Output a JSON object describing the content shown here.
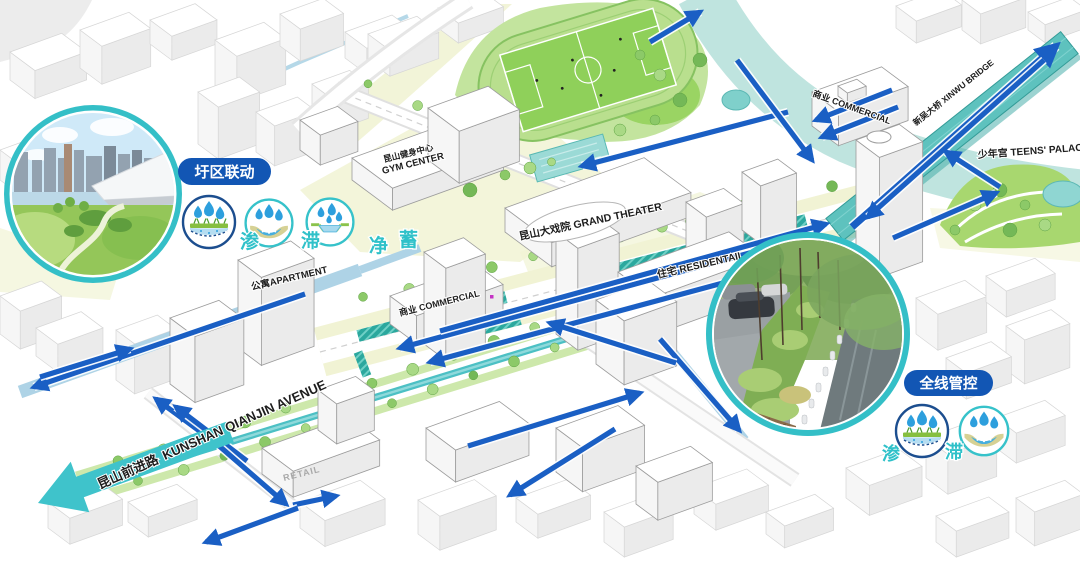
{
  "annotations": {
    "left_group": {
      "label": "圩区联动",
      "chars": [
        "渗",
        "滞",
        "净",
        "蓄"
      ],
      "icon_names": [
        "infiltrate-icon",
        "detain-icon",
        "purify-icon"
      ]
    },
    "right_group": {
      "label": "全线管控",
      "chars": [
        "渗",
        "滞"
      ],
      "icon_names": [
        "infiltrate-icon",
        "detain-icon"
      ]
    }
  },
  "labels": {
    "gym_cn": "昆山健身中心",
    "gym_en": "GYM CENTER",
    "theater": "昆山大戏院 GRAND THEATER",
    "apartment": "公寓APARTMENT",
    "commercial_center": "商业 COMMERCIAL",
    "commercial_north": "商业 COMMERCIAL",
    "residential": "住宅 RESIDENTAIL",
    "teens_palace": "少年宫 TEENS' PALACE",
    "bridge": "新吴大桥 XINWU BRIDGE",
    "retail": "RETAIL",
    "avenue_cn": "昆山前进路",
    "avenue_en": "KUNSHAN QIANJIN AVENUE"
  },
  "colors": {
    "flow_arrow_blue": "#1a5fc4",
    "accent_teal": "#3fc3cb",
    "pill_blue": "#1256b4",
    "park_green": "#a2d45f",
    "canal_blue": "#aed3e6",
    "river_teal": "#bfe4df",
    "swale_teal": "#2ba89e",
    "pale_yellow": "#f1f3d4"
  }
}
